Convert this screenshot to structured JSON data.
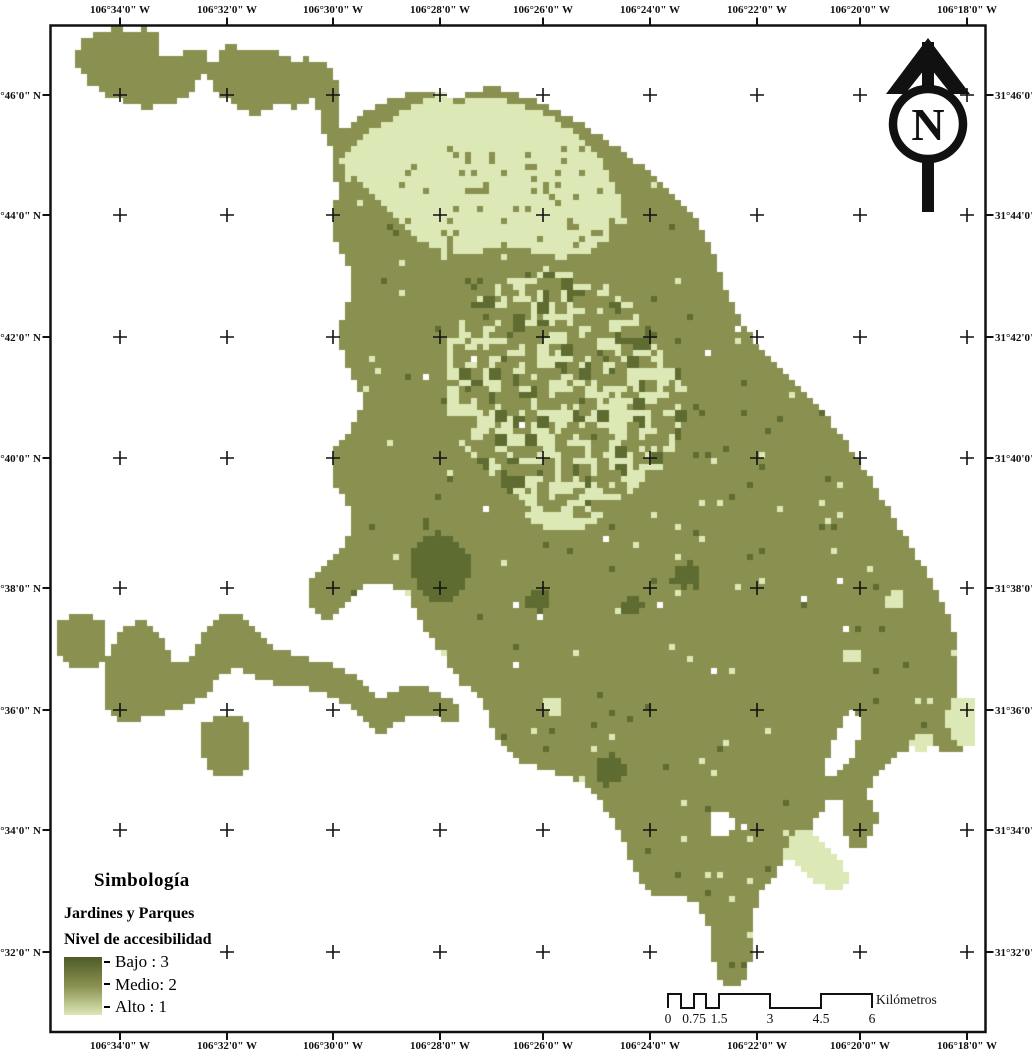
{
  "axis": {
    "lon_labels": [
      "106°34'0\" W",
      "106°32'0\" W",
      "106°30'0\" W",
      "106°28'0\" W",
      "106°26'0\" W",
      "106°24'0\" W",
      "106°22'0\" W",
      "106°20'0\" W",
      "106°18'0\" W"
    ],
    "lat_labels": [
      "31°46'0\" N",
      "31°44'0\" N",
      "31°42'0\" N",
      "31°40'0\" N",
      "31°38'0\" N",
      "31°36'0\" N",
      "31°34'0\" N",
      "31°32'0\" N"
    ]
  },
  "north_arrow": {
    "label": "N"
  },
  "legend": {
    "title": "Simbología",
    "layer": "Jardines y Parques",
    "field": "Nivel de accesibilidad",
    "entries": [
      {
        "label": "Bajo : 3"
      },
      {
        "label": "Medio: 2"
      },
      {
        "label": "Alto : 1"
      }
    ],
    "gradient": [
      "#4F5B28",
      "#8A9150",
      "#DCE8B6"
    ]
  },
  "scalebar": {
    "ticks": [
      "0",
      "0.75",
      "1.5",
      "3",
      "4.5",
      "6"
    ],
    "unit": "Kilómetros"
  },
  "colors": {
    "white": "#FFFFFF",
    "olive": "#8A9150",
    "light": "#DCE8B6",
    "dark": "#5E6C31",
    "ink": "#111111"
  },
  "map_shapes": [
    {
      "name": "far-left-square",
      "color": "olive",
      "pts": [
        58,
        622,
        72,
        616,
        88,
        615,
        102,
        620,
        105,
        634,
        103,
        650,
        105,
        662,
        96,
        668,
        82,
        668,
        68,
        665,
        58,
        655,
        56,
        638
      ]
    },
    {
      "name": "west-arm",
      "color": "olive",
      "pts": [
        105,
        662,
        110,
        648,
        118,
        636,
        128,
        626,
        140,
        620,
        152,
        624,
        160,
        634,
        166,
        646,
        172,
        658,
        180,
        664,
        190,
        660,
        196,
        648,
        202,
        636,
        210,
        624,
        220,
        616,
        232,
        612,
        244,
        616,
        252,
        626,
        260,
        636,
        270,
        644,
        282,
        650,
        295,
        655,
        308,
        658,
        322,
        662,
        335,
        666,
        348,
        672,
        360,
        680,
        370,
        690,
        378,
        700,
        388,
        694,
        398,
        688,
        410,
        686,
        424,
        688,
        436,
        692,
        448,
        698,
        458,
        706,
        462,
        716,
        455,
        724,
        443,
        720,
        430,
        717,
        416,
        717,
        403,
        720,
        393,
        727,
        383,
        734,
        373,
        730,
        365,
        720,
        355,
        710,
        342,
        702,
        328,
        695,
        312,
        690,
        296,
        687,
        280,
        684,
        264,
        680,
        250,
        674,
        238,
        668,
        226,
        672,
        216,
        682,
        206,
        694,
        195,
        703,
        182,
        708,
        168,
        712,
        154,
        715,
        140,
        719,
        128,
        723,
        116,
        719,
        108,
        708,
        104,
        693,
        103,
        678
      ]
    },
    {
      "name": "southwest-blob",
      "color": "olive",
      "pts": [
        200,
        724,
        216,
        718,
        232,
        716,
        248,
        720,
        252,
        734,
        250,
        748,
        252,
        762,
        245,
        774,
        232,
        778,
        218,
        775,
        208,
        766,
        202,
        752,
        198,
        738
      ]
    },
    {
      "name": "northwest-blob",
      "color": "olive",
      "pts": [
        78,
        48,
        88,
        36,
        102,
        30,
        118,
        28,
        134,
        30,
        148,
        28,
        158,
        34,
        162,
        45,
        155,
        52,
        162,
        58,
        175,
        55,
        188,
        50,
        200,
        48,
        206,
        52,
        206,
        62,
        212,
        66,
        218,
        60,
        218,
        50,
        228,
        46,
        242,
        48,
        255,
        52,
        268,
        50,
        282,
        55,
        295,
        60,
        308,
        58,
        320,
        62,
        332,
        68,
        336,
        78,
        340,
        92,
        338,
        108,
        340,
        122,
        336,
        136,
        333,
        148,
        326,
        138,
        320,
        126,
        318,
        112,
        314,
        100,
        305,
        104,
        292,
        108,
        280,
        104,
        268,
        110,
        255,
        114,
        242,
        110,
        232,
        102,
        222,
        96,
        215,
        88,
        212,
        78,
        205,
        75,
        198,
        82,
        192,
        92,
        182,
        99,
        170,
        103,
        158,
        106,
        145,
        108,
        132,
        105,
        120,
        100,
        108,
        95,
        95,
        88,
        85,
        78,
        78,
        65
      ]
    },
    {
      "name": "main-body",
      "color": "olive",
      "pts": [
        333,
        140,
        340,
        132,
        350,
        124,
        362,
        115,
        375,
        108,
        390,
        100,
        405,
        95,
        420,
        92,
        435,
        90,
        450,
        95,
        458,
        102,
        465,
        95,
        478,
        90,
        492,
        88,
        508,
        90,
        522,
        95,
        538,
        102,
        552,
        108,
        565,
        115,
        578,
        122,
        592,
        130,
        605,
        138,
        618,
        148,
        632,
        158,
        645,
        169,
        658,
        180,
        672,
        192,
        684,
        204,
        694,
        216,
        702,
        229,
        708,
        242,
        714,
        256,
        719,
        270,
        724,
        284,
        730,
        298,
        737,
        312,
        745,
        326,
        754,
        339,
        764,
        352,
        776,
        365,
        789,
        378,
        802,
        391,
        815,
        404,
        828,
        418,
        840,
        432,
        850,
        446,
        860,
        461,
        870,
        477,
        880,
        494,
        890,
        511,
        900,
        528,
        910,
        545,
        920,
        562,
        930,
        579,
        940,
        597,
        948,
        614,
        954,
        631,
        959,
        649,
        958,
        666,
        956,
        681,
        960,
        695,
        968,
        708,
        973,
        722,
        972,
        738,
        965,
        748,
        952,
        753,
        938,
        749,
        925,
        745,
        912,
        748,
        900,
        755,
        890,
        764,
        880,
        772,
        872,
        782,
        868,
        795,
        872,
        808,
        878,
        818,
        875,
        831,
        868,
        842,
        859,
        850,
        850,
        845,
        843,
        832,
        840,
        818,
        843,
        805,
        837,
        796,
        829,
        801,
        821,
        811,
        814,
        822,
        807,
        833,
        799,
        843,
        791,
        853,
        784,
        863,
        777,
        873,
        769,
        883,
        762,
        893,
        758,
        903,
        754,
        916,
        751,
        930,
        752,
        945,
        750,
        960,
        746,
        974,
        739,
        985,
        729,
        988,
        720,
        978,
        714,
        962,
        713,
        946,
        710,
        930,
        705,
        916,
        698,
        906,
        688,
        899,
        676,
        896,
        664,
        898,
        652,
        893,
        643,
        883,
        636,
        870,
        629,
        856,
        623,
        842,
        616,
        828,
        609,
        815,
        602,
        803,
        594,
        792,
        584,
        784,
        572,
        778,
        559,
        774,
        545,
        770,
        531,
        765,
        517,
        759,
        506,
        750,
        498,
        738,
        492,
        725,
        487,
        712,
        481,
        700,
        472,
        692,
        462,
        684,
        453,
        672,
        446,
        660,
        438,
        648,
        430,
        637,
        423,
        625,
        417,
        612,
        411,
        601,
        404,
        593,
        394,
        587,
        382,
        584,
        369,
        584,
        358,
        590,
        350,
        598,
        343,
        607,
        336,
        614,
        328,
        619,
        319,
        618,
        312,
        610,
        308,
        599,
        309,
        588,
        313,
        577,
        320,
        569,
        328,
        562,
        336,
        554,
        343,
        546,
        348,
        536,
        351,
        524,
        350,
        511,
        346,
        500,
        339,
        491,
        333,
        482,
        330,
        471,
        331,
        459,
        336,
        448,
        343,
        439,
        350,
        430,
        357,
        420,
        361,
        408,
        361,
        395,
        357,
        383,
        351,
        372,
        345,
        361,
        341,
        349,
        340,
        336,
        342,
        323,
        346,
        310,
        350,
        297,
        351,
        284,
        349,
        271,
        344,
        260,
        339,
        249,
        335,
        237,
        334,
        224,
        335,
        210,
        337,
        196,
        336,
        182,
        334,
        168,
        333,
        154
      ]
    },
    {
      "name": "north-light-patch",
      "color": "light",
      "pts": [
        340,
        158,
        355,
        142,
        372,
        130,
        392,
        118,
        412,
        106,
        428,
        98,
        438,
        92,
        452,
        98,
        460,
        106,
        470,
        98,
        482,
        95,
        498,
        98,
        512,
        102,
        528,
        108,
        545,
        115,
        558,
        122,
        572,
        130,
        585,
        140,
        596,
        152,
        605,
        165,
        612,
        180,
        618,
        195,
        622,
        210,
        618,
        225,
        608,
        238,
        595,
        248,
        580,
        255,
        562,
        258,
        545,
        255,
        528,
        250,
        512,
        245,
        495,
        248,
        478,
        252,
        462,
        255,
        445,
        252,
        428,
        245,
        412,
        235,
        398,
        222,
        385,
        208,
        372,
        195,
        360,
        182,
        348,
        170
      ]
    },
    {
      "name": "central-light-blob",
      "color": "light",
      "pts": [
        450,
        340,
        462,
        318,
        478,
        300,
        495,
        288,
        512,
        280,
        530,
        275,
        548,
        272,
        565,
        270,
        582,
        272,
        600,
        278,
        618,
        288,
        635,
        300,
        650,
        315,
        662,
        332,
        672,
        350,
        680,
        370,
        685,
        390,
        686,
        410,
        682,
        430,
        674,
        448,
        662,
        465,
        648,
        480,
        632,
        492,
        615,
        500,
        596,
        506,
        576,
        509,
        556,
        508,
        536,
        504,
        517,
        496,
        500,
        485,
        485,
        472,
        472,
        458,
        461,
        442,
        453,
        425,
        448,
        408,
        446,
        390,
        447,
        372,
        448,
        355
      ]
    },
    {
      "name": "central-light-tail",
      "color": "light",
      "pts": [
        520,
        505,
        545,
        498,
        570,
        500,
        595,
        495,
        610,
        505,
        600,
        520,
        580,
        530,
        555,
        532,
        535,
        525
      ]
    },
    {
      "name": "dark-square-patch",
      "color": "dark",
      "pts": [
        413,
        548,
        425,
        536,
        440,
        532,
        455,
        538,
        465,
        548,
        470,
        560,
        471,
        575,
        464,
        589,
        452,
        599,
        437,
        602,
        424,
        596,
        416,
        584,
        410,
        568,
        410,
        556
      ]
    },
    {
      "name": "dark-spot-south",
      "color": "dark",
      "pts": [
        598,
        758,
        612,
        754,
        623,
        760,
        626,
        772,
        620,
        783,
        607,
        786,
        597,
        779,
        594,
        768
      ]
    },
    {
      "name": "dark-spot-1",
      "color": "dark",
      "pts": [
        676,
        566,
        690,
        562,
        699,
        570,
        697,
        582,
        686,
        588,
        675,
        583,
        672,
        574
      ]
    },
    {
      "name": "dark-spot-2",
      "color": "dark",
      "pts": [
        530,
        594,
        544,
        590,
        552,
        597,
        550,
        608,
        538,
        612,
        528,
        606,
        526,
        599
      ]
    },
    {
      "name": "dark-spot-3",
      "color": "dark",
      "pts": [
        624,
        600,
        636,
        596,
        643,
        603,
        641,
        613,
        630,
        616,
        622,
        610
      ]
    },
    {
      "name": "light-spot-1",
      "color": "light",
      "pts": [
        545,
        700,
        558,
        696,
        565,
        703,
        562,
        713,
        550,
        716,
        542,
        709
      ]
    },
    {
      "name": "light-spot-2",
      "color": "light",
      "pts": [
        916,
        736,
        928,
        732,
        933,
        740,
        929,
        749,
        918,
        750,
        912,
        743
      ]
    },
    {
      "name": "light-spot-3",
      "color": "light",
      "pts": [
        888,
        594,
        900,
        590,
        906,
        598,
        902,
        608,
        890,
        610,
        884,
        602
      ]
    },
    {
      "name": "light-spot-4",
      "color": "light",
      "pts": [
        845,
        650,
        857,
        646,
        863,
        654,
        859,
        663,
        847,
        665,
        841,
        657
      ]
    },
    {
      "name": "light-streak-se",
      "color": "light",
      "pts": [
        783,
        852,
        790,
        839,
        799,
        831,
        810,
        832,
        821,
        840,
        831,
        850,
        839,
        860,
        846,
        871,
        847,
        884,
        838,
        891,
        826,
        889,
        814,
        881,
        802,
        871,
        791,
        861,
        784,
        857
      ]
    },
    {
      "name": "light-strip-east",
      "color": "light",
      "pts": [
        950,
        700,
        962,
        696,
        972,
        700,
        975,
        714,
        973,
        730,
        975,
        742,
        966,
        748,
        955,
        744,
        948,
        730,
        947,
        714
      ]
    },
    {
      "name": "white-wedge-se",
      "color": "white",
      "pts": [
        822,
        770,
        832,
        748,
        840,
        726,
        850,
        712,
        860,
        716,
        861,
        732,
        855,
        750,
        847,
        764,
        837,
        774,
        828,
        776
      ]
    },
    {
      "name": "white-hole",
      "color": "white",
      "pts": [
        712,
        815,
        724,
        810,
        733,
        816,
        734,
        828,
        728,
        838,
        716,
        837,
        710,
        828
      ]
    }
  ],
  "speckles": [
    {
      "name": "central-mottle-blocks",
      "rect": [
        455,
        275,
        680,
        505
      ],
      "on": "light",
      "color": "olive",
      "density": 0.16,
      "seed": 11,
      "block": 2
    },
    {
      "name": "central-mottle-dark",
      "rect": [
        455,
        275,
        680,
        505
      ],
      "on": "light",
      "color": "dark",
      "density": 0.1,
      "seed": 19,
      "block": 2
    },
    {
      "name": "central-mottle-fine",
      "rect": [
        450,
        270,
        686,
        512
      ],
      "on": "light",
      "color": "olive",
      "density": 0.18,
      "seed": 29,
      "block": 1
    },
    {
      "name": "north-mottle",
      "rect": [
        400,
        150,
        620,
        250
      ],
      "on": "light",
      "color": "olive",
      "density": 0.13,
      "seed": 41,
      "block": 1
    },
    {
      "name": "body-light-dots",
      "rect": [
        345,
        120,
        960,
        980
      ],
      "on": "olive",
      "color": "light",
      "density": 0.012,
      "seed": 59,
      "block": 1
    },
    {
      "name": "body-dark-dots",
      "rect": [
        345,
        120,
        960,
        980
      ],
      "on": "olive",
      "color": "dark",
      "density": 0.012,
      "seed": 67,
      "block": 1
    },
    {
      "name": "body-white-holes",
      "rect": [
        420,
        300,
        900,
        900
      ],
      "on": "olive",
      "color": "white",
      "density": 0.003,
      "seed": 83,
      "block": 1
    }
  ]
}
